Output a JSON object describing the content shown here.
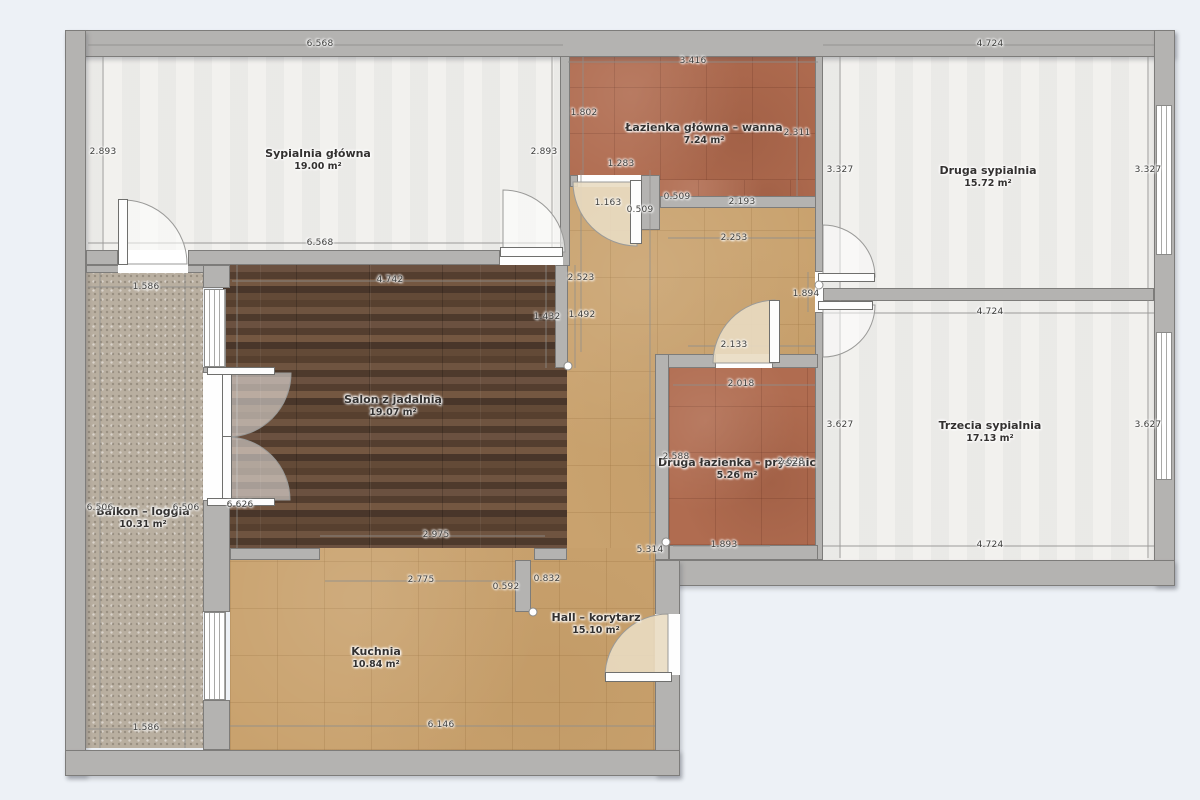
{
  "plan_type": "apartment floor plan",
  "colors": {
    "background": "#edf1f6",
    "wall": "#b4b3b1",
    "wall_border": "#7d7c7a",
    "floor_white_room": "#f2f1ee",
    "floor_hall_kitchen": "#c9a26e",
    "floor_bathroom": "#b06c50",
    "floor_living_wood": "#5b4434",
    "floor_balcony": "#b9afa0"
  },
  "rooms": [
    {
      "name": "Sypialnia główna",
      "area": "19.00 m²"
    },
    {
      "name": "Łazienka główna – wanna",
      "area": "7.24 m²"
    },
    {
      "name": "Druga sypialnia",
      "area": "15.72 m²"
    },
    {
      "name": "Trzecia sypialnia",
      "area": "17.13 m²"
    },
    {
      "name": "Salon z jadalnią",
      "area": "19.07 m²"
    },
    {
      "name": "Balkon – loggia",
      "area": "10.31 m²"
    },
    {
      "name": "Druga łazienka – prysznic",
      "area": "5.26 m²"
    },
    {
      "name": "Hall – korytarz",
      "area": "15.10 m²"
    },
    {
      "name": "Kuchnia",
      "area": "10.84 m²"
    }
  ],
  "dims": [
    "6.568",
    "3.416",
    "4.724",
    "2.893",
    "2.893",
    "1.802",
    "2.311",
    "3.327",
    "3.327",
    "6.568",
    "1.283",
    "1.163",
    "0.509",
    "0.509",
    "2.193",
    "2.253",
    "1.586",
    "4.742",
    "2.523",
    "1.492",
    "1.432",
    "1.894",
    "2.133",
    "4.724",
    "2.018",
    "2.588",
    "2.628",
    "3.627",
    "3.627",
    "6.506",
    "6.506",
    "6.626",
    "2.975",
    "1.893",
    "4.724",
    "5.314",
    "2.775",
    "0.592",
    "0.832",
    "1.586",
    "6.146"
  ]
}
